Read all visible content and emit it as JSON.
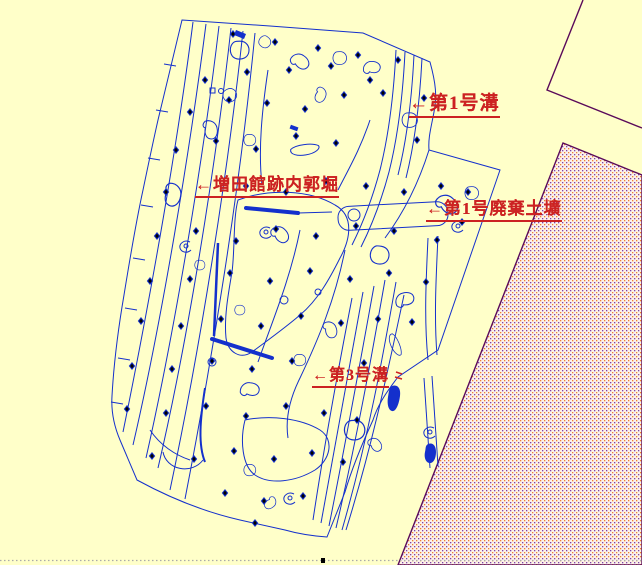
{
  "map": {
    "title": "excavation site plan",
    "labels": [
      {
        "id": "ditch-1",
        "text": "←第1号溝"
      },
      {
        "id": "inner-moat",
        "text": "←増田館跡内郭堀"
      },
      {
        "id": "waste-pit-1",
        "text": "←第1号廃棄土壙"
      },
      {
        "id": "ditch-3",
        "text": "←第3号溝"
      }
    ],
    "colors": {
      "background": "#FFFFC9",
      "feature_lines": "#1430CC",
      "survey_points": "#000000",
      "label_text": "#CC2222",
      "boundary_road_line": "#5A0A5A",
      "hatch_dot_orange": "#F08030",
      "hatch_dot_purple": "#8040A8",
      "hatch_background": "#FBF2EA"
    }
  }
}
